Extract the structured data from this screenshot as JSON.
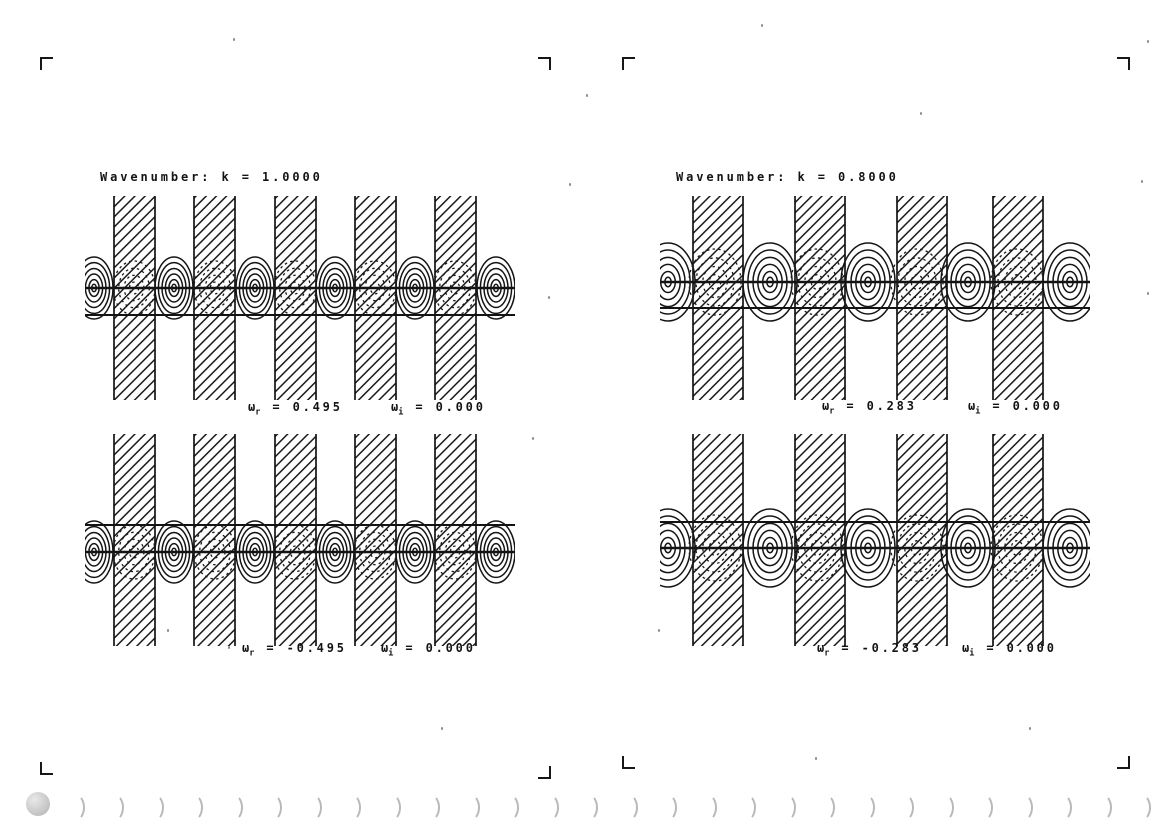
{
  "page": {
    "background": "#ffffff",
    "ink": "#141414",
    "binding": {
      "count": 29,
      "color": "#bcbcbc"
    },
    "noise_dots": [
      [
        233,
        38
      ],
      [
        761,
        24
      ],
      [
        920,
        112
      ],
      [
        1147,
        40
      ],
      [
        569,
        183
      ],
      [
        1141,
        180
      ],
      [
        548,
        296
      ],
      [
        1147,
        292
      ],
      [
        532,
        437
      ],
      [
        228,
        646
      ],
      [
        658,
        629
      ],
      [
        441,
        727
      ],
      [
        1029,
        727
      ],
      [
        167,
        629
      ],
      [
        586,
        94
      ],
      [
        815,
        757
      ]
    ]
  },
  "figure": {
    "panels": [
      {
        "name": "top-left",
        "title": "Wavenumber: k = 1.0000",
        "k": "1.0000",
        "omega_r": {
          "symbol": "ω",
          "sub": "r",
          "eq": "=",
          "value": "0.495"
        },
        "omega_i": {
          "symbol": "ω",
          "sub": "i",
          "eq": "=",
          "value": "0.000"
        },
        "geom": {
          "width": 430,
          "height": 212,
          "barTop": 6,
          "barBottom": 210,
          "barStarts": [
            29,
            109,
            190,
            270,
            350
          ],
          "barWidth": 41,
          "cellCenters": [
            9,
            89,
            170,
            250,
            330,
            411
          ],
          "dashCenters": [
            49,
            130,
            210,
            290,
            370
          ],
          "centerY": 98,
          "secondY": 125,
          "cellRx": 19,
          "cellRy": 31,
          "dashRx": 21,
          "dashRy": 27
        }
      },
      {
        "name": "top-right",
        "title": "Wavenumber: k = 0.8000",
        "k": "0.8000",
        "omega_r": {
          "symbol": "ω",
          "sub": "r",
          "eq": "=",
          "value": "0.283"
        },
        "omega_i": {
          "symbol": "ω",
          "sub": "i",
          "eq": "=",
          "value": "0.000"
        },
        "geom": {
          "width": 430,
          "height": 212,
          "barTop": 6,
          "barBottom": 210,
          "barStarts": [
            33,
            135,
            237,
            333
          ],
          "barWidth": 50,
          "cellCenters": [
            8,
            110,
            208,
            308,
            410
          ],
          "dashCenters": [
            55,
            157,
            257,
            357
          ],
          "centerY": 92,
          "secondY": 118,
          "cellRx": 27,
          "cellRy": 39,
          "dashRx": 26,
          "dashRy": 33
        }
      },
      {
        "name": "bottom-left",
        "omega_r": {
          "symbol": "ω",
          "sub": "r",
          "eq": "=",
          "value": "-0.495"
        },
        "omega_i": {
          "symbol": "ω",
          "sub": "i",
          "eq": "=",
          "value": "0.000"
        },
        "geom": {
          "width": 430,
          "height": 220,
          "barTop": 6,
          "barBottom": 218,
          "barStarts": [
            29,
            109,
            190,
            270,
            350
          ],
          "barWidth": 41,
          "cellCenters": [
            9,
            89,
            170,
            250,
            330,
            411
          ],
          "dashCenters": [
            49,
            130,
            210,
            290,
            370
          ],
          "centerY": 124,
          "secondY": 97,
          "cellRx": 19,
          "cellRy": 31,
          "dashRx": 21,
          "dashRy": 27
        }
      },
      {
        "name": "bottom-right",
        "omega_r": {
          "symbol": "ω",
          "sub": "r",
          "eq": "=",
          "value": "-0.283"
        },
        "omega_i": {
          "symbol": "ω",
          "sub": "i",
          "eq": "=",
          "value": "0.000"
        },
        "geom": {
          "width": 430,
          "height": 220,
          "barTop": 6,
          "barBottom": 218,
          "barStarts": [
            33,
            135,
            237,
            333
          ],
          "barWidth": 50,
          "cellCenters": [
            8,
            110,
            208,
            308,
            410
          ],
          "dashCenters": [
            55,
            157,
            257,
            357
          ],
          "centerY": 120,
          "secondY": 94,
          "cellRx": 27,
          "cellRy": 39,
          "dashRx": 26,
          "dashRy": 33
        }
      }
    ]
  }
}
